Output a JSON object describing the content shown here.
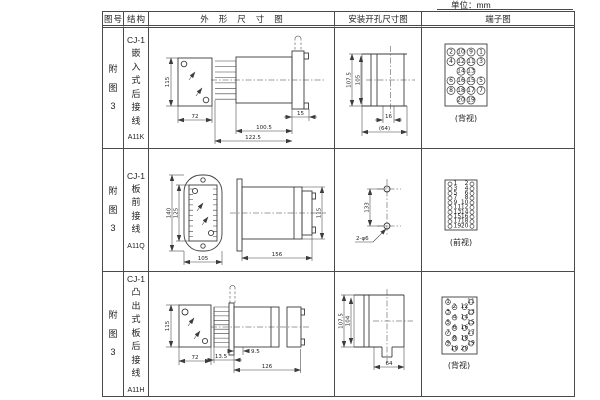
{
  "unit_label": "单位：mm",
  "headers": {
    "fig": "图号",
    "structure": "结构",
    "outline": "外形尺寸图",
    "mounting": "安装开孔尺寸图",
    "terminal": "端子图"
  },
  "rows": [
    {
      "fig": "附图3",
      "model": "CJ-1",
      "structure_type": "嵌入式后接线",
      "code": "A11K",
      "dims": {
        "front_h": "115",
        "front_w": "72",
        "body_len": "100.5",
        "total_len": "122.5",
        "flange_w": "15"
      },
      "mount": {
        "outer_h": "107.5",
        "inner_h": "105",
        "inner_w": "16",
        "outer_w": "(64)"
      },
      "terminal_view": "(背视)"
    },
    {
      "fig": "附图3",
      "model": "CJ-1",
      "structure_type": "板前接线",
      "code": "A11Q",
      "dims": {
        "front_h": "140",
        "inner_h": "125",
        "front_w": "105",
        "body_len": "156",
        "side_h": "115"
      },
      "mount": {
        "hole_spacing": "133",
        "hole_label": "2-φ6"
      },
      "terminal_view": "(前视)"
    },
    {
      "fig": "附图3",
      "model": "CJ-1",
      "structure_type": "凸出式板后接线",
      "code": "A11H",
      "dims": {
        "front_h": "115",
        "front_w": "72",
        "pin_len": "13.5",
        "offset": "9.5",
        "body_len": "126"
      },
      "mount": {
        "outer_h": "107.5",
        "inner_h": "104",
        "outer_w": "64"
      },
      "terminal_view": "(背视)"
    }
  ],
  "terminals": {
    "a11k": {
      "grid": [
        [
          "2",
          "10",
          "9",
          "1"
        ],
        [
          "4",
          "12",
          "11",
          "3"
        ],
        [
          "",
          "14",
          "13",
          ""
        ],
        [
          "6",
          "16",
          "15",
          "5"
        ],
        [
          "8",
          "18",
          "17",
          "7"
        ],
        [
          "",
          "20",
          "19",
          ""
        ]
      ]
    },
    "a11q": {
      "left": [
        "1",
        "3",
        "5",
        "7",
        "9",
        "11",
        "13",
        "15",
        "17",
        "19"
      ],
      "right": [
        "2",
        "4",
        "6",
        "8",
        "10",
        "12",
        "14",
        "16",
        "18",
        "20"
      ]
    },
    "a11h": {
      "left": [
        "1",
        "2",
        "3",
        "4",
        "5",
        "6",
        "7",
        "8",
        "9",
        "10"
      ],
      "right": [
        "11",
        "12",
        "13",
        "14",
        "15",
        "16",
        "17",
        "18",
        "19",
        "20"
      ]
    }
  }
}
